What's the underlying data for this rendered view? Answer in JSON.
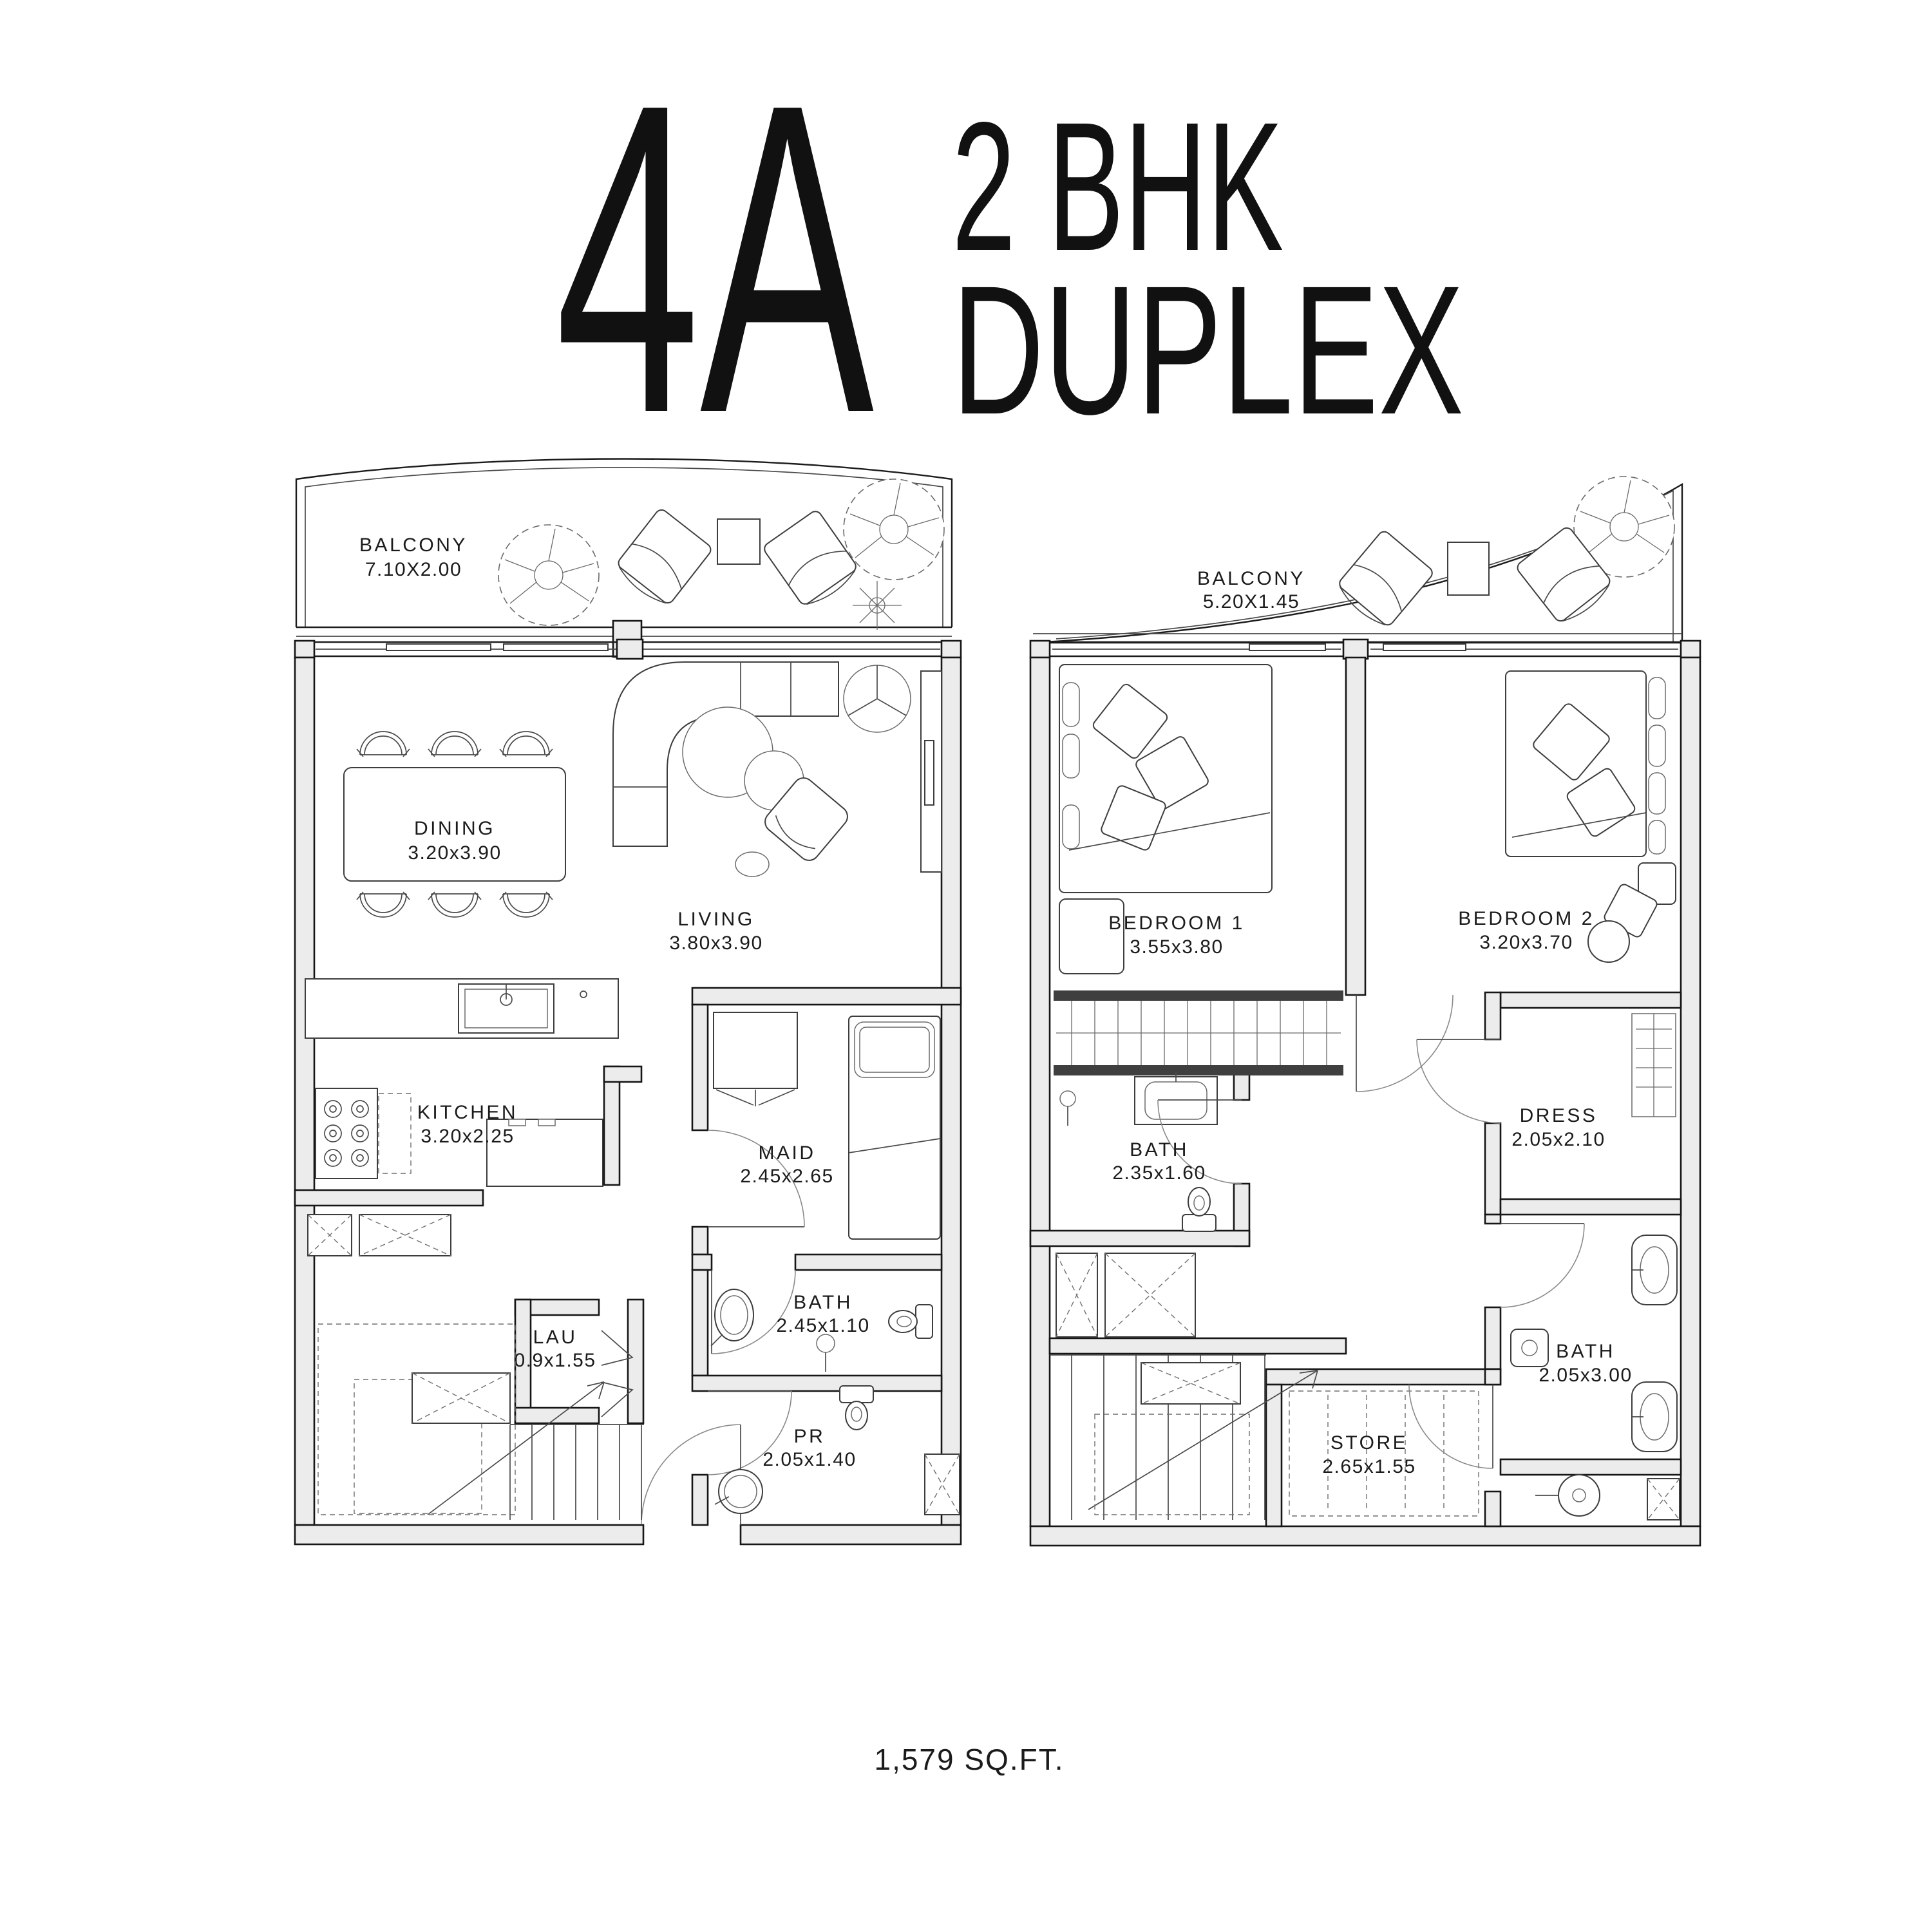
{
  "title": {
    "unit_label": "4A",
    "type_line1": "2 BHK",
    "type_line2": "DUPLEX"
  },
  "footer": {
    "area_label": "1,579 SQ.FT."
  },
  "colors": {
    "line": "#1b1b1b",
    "wall_fill": "#ececec",
    "background": "#ffffff"
  },
  "floor1": {
    "rooms": [
      {
        "id": "balcony",
        "name": "BALCONY",
        "dims": "7.10X2.00"
      },
      {
        "id": "dining",
        "name": "DINING",
        "dims": "3.20x3.90"
      },
      {
        "id": "living",
        "name": "LIVING",
        "dims": "3.80x3.90"
      },
      {
        "id": "kitchen",
        "name": "KITCHEN",
        "dims": "3.20x2.25"
      },
      {
        "id": "maid",
        "name": "MAID",
        "dims": "2.45x2.65"
      },
      {
        "id": "bath",
        "name": "BATH",
        "dims": "2.45x1.10"
      },
      {
        "id": "laundry",
        "name": "LAU",
        "dims": "0.9x1.55"
      },
      {
        "id": "powder",
        "name": "PR",
        "dims": "2.05x1.40"
      }
    ]
  },
  "floor2": {
    "rooms": [
      {
        "id": "balcony",
        "name": "BALCONY",
        "dims": "5.20X1.45"
      },
      {
        "id": "bedroom1",
        "name": "BEDROOM 1",
        "dims": "3.55x3.80"
      },
      {
        "id": "bedroom2",
        "name": "BEDROOM 2",
        "dims": "3.20x3.70"
      },
      {
        "id": "bath",
        "name": "BATH",
        "dims": "2.35x1.60"
      },
      {
        "id": "dress",
        "name": "DRESS",
        "dims": "2.05x2.10"
      },
      {
        "id": "bath2",
        "name": "BATH",
        "dims": "2.05x3.00"
      },
      {
        "id": "store",
        "name": "STORE",
        "dims": "2.65x1.55"
      }
    ]
  }
}
